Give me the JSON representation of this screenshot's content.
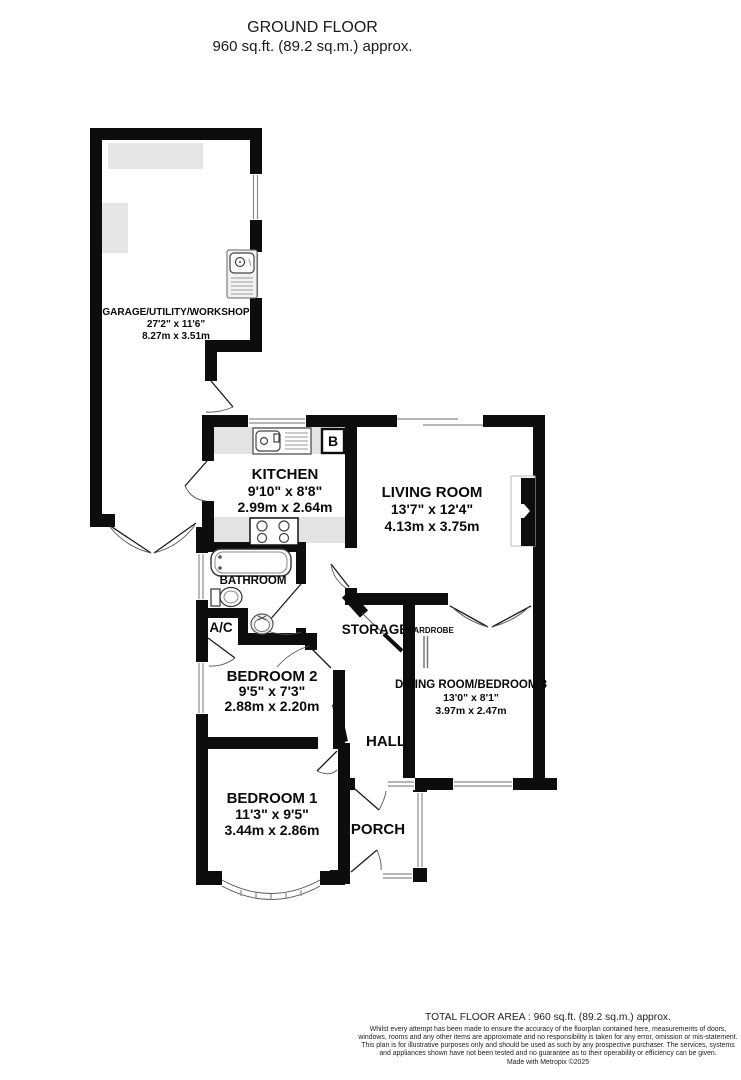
{
  "header": {
    "title": "GROUND FLOOR",
    "subtitle": "960 sq.ft. (89.2 sq.m.) approx."
  },
  "rooms": {
    "garage": {
      "name": "GARAGE/UTILITY/WORKSHOP",
      "imperial": "27'2\" x 11'6\"",
      "metric": "8.27m x 3.51m"
    },
    "kitchen": {
      "name": "KITCHEN",
      "imperial": "9'10\" x 8'8\"",
      "metric": "2.99m x 2.64m"
    },
    "living_room": {
      "name": "LIVING ROOM",
      "imperial": "13'7\" x 12'4\"",
      "metric": "4.13m x 3.75m"
    },
    "bathroom": {
      "name": "BATHROOM"
    },
    "airing_cupboard": {
      "name": "A/C"
    },
    "bedroom2": {
      "name": "BEDROOM 2",
      "imperial": "9'5\" x 7'3\"",
      "metric": "2.88m x 2.20m"
    },
    "storage": {
      "name": "STORAGE"
    },
    "wardrobe": {
      "name": "WARDROBE"
    },
    "dining_room": {
      "name": "DINING ROOM/BEDROOM 3",
      "imperial": "13'0\" x 8'1\"",
      "metric": "3.97m x 2.47m"
    },
    "hall": {
      "name": "HALL"
    },
    "bedroom1": {
      "name": "BEDROOM 1",
      "imperial": "11'3\" x 9'5\"",
      "metric": "3.44m x 2.86m"
    },
    "porch": {
      "name": "PORCH"
    }
  },
  "symbols": {
    "boiler": "B"
  },
  "footer": {
    "total": "TOTAL FLOOR AREA : 960 sq.ft. (89.2 sq.m.) approx.",
    "disclaimer": "Whilst every attempt has been made to ensure the accuracy of the floorplan contained here, measurements of doors, windows, rooms and any other items are approximate and no responsibility is taken for any error, omission or mis-statement. This plan is for illustrative purposes only and should be used as such by any prospective purchaser. The services, systems and appliances shown have not been tested and no guarantee as to their operability or efficiency can be given.",
    "credit": "Made with Metropix ©2025"
  },
  "colors": {
    "wall": "#0d0d0d",
    "floor": "#ffffff",
    "counter": "#e3e3e3",
    "window_line": "#8a8a8a"
  }
}
